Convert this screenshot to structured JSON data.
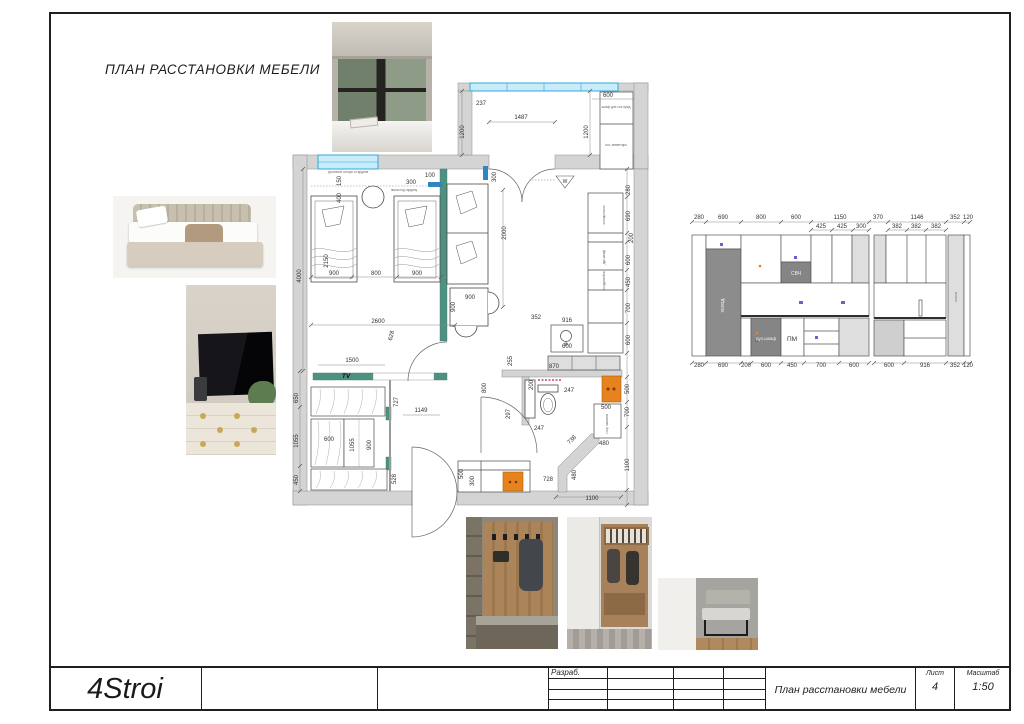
{
  "page": {
    "title": "ПЛАН РАССТАНОВКИ МЕБЕЛИ"
  },
  "colors": {
    "wall": "#d4d4d4",
    "teal": "#4e9183",
    "window": "#c9ecfa",
    "windowframe": "#35a7dd",
    "orange": "#e8821e",
    "appliance": "#8c8c8c",
    "panel": "#dedede",
    "accentblue": "#2e86c1",
    "pink": "#c2185b",
    "ink": "#3a3a3a"
  },
  "plan": {
    "balcony": [
      "237",
      "1200",
      "1487",
      "600",
      "1200"
    ],
    "win": [
      "300",
      "100",
      "300"
    ],
    "bedroom": [
      "400",
      "150",
      "2150",
      "900",
      "800",
      "900",
      "4000",
      "2600",
      "628",
      "1500"
    ],
    "closet": [
      "650",
      "1055",
      "450",
      "600",
      "1055",
      "900",
      "727",
      "1149",
      "528"
    ],
    "living": [
      "2000",
      "900",
      "900"
    ],
    "kright": [
      "280",
      "690",
      "200",
      "600",
      "450",
      "700",
      "600"
    ],
    "bath": [
      "352",
      "916",
      "600",
      "255",
      "870",
      "800",
      "200",
      "247",
      "297",
      "247",
      "738",
      "480",
      "480",
      "1100",
      "1100",
      "700",
      "500",
      "500",
      "728",
      "500",
      "300"
    ],
    "labels": {
      "tv": "TV",
      "vent": "W",
      "fridge": "холодильник",
      "oven": "дух.шкаф",
      "dw": "посудомойка",
      "balc1": "шкаф для хоз.нужд",
      "balc2": "хоз. инвентарь",
      "blind": "рулонные шторы и гардина",
      "niche": "ниша под гардину",
      "washer": "стир. машина"
    }
  },
  "elev": {
    "top": [
      "280",
      "690",
      "800",
      "600",
      "1150",
      "370",
      "1146",
      "352",
      "120"
    ],
    "mid": [
      "425",
      "425",
      "300",
      "382",
      "382",
      "382"
    ],
    "bot": [
      "280",
      "690",
      "200",
      "600",
      "450",
      "700",
      "600",
      "600",
      "916",
      "352",
      "120"
    ],
    "labels": {
      "fridge": "холод.",
      "mw": "СВЧ",
      "oven": "дух.шкаф",
      "pm": "ПМ",
      "niche": "ниша"
    }
  },
  "titleblock": {
    "logo": "4Stroi",
    "developed": "Разраб.",
    "name": "План расстановки мебели",
    "sheet_label": "Лист",
    "sheet": "4",
    "scale_label": "Масштаб",
    "scale": "1:50"
  }
}
